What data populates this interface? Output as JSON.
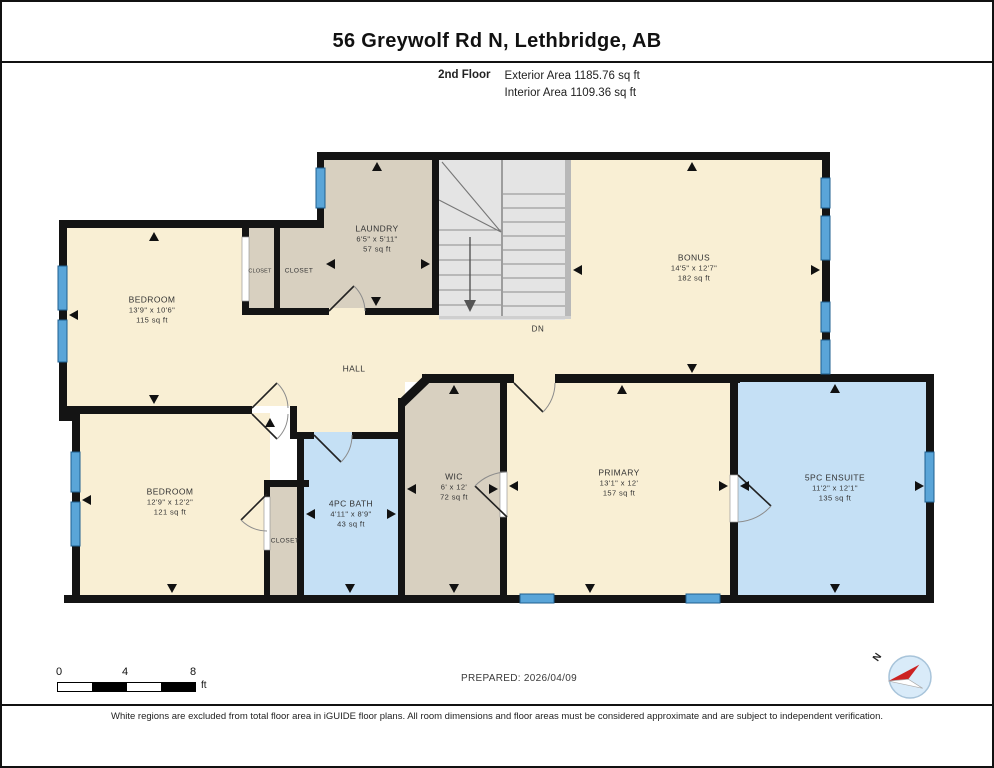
{
  "header": {
    "title": "56 Greywolf Rd N, Lethbridge, AB",
    "floor": "2nd Floor",
    "exterior": "Exterior Area 1185.76 sq ft",
    "interior": "Interior Area 1109.36 sq ft"
  },
  "rooms": {
    "bedroom1": {
      "name": "BEDROOM",
      "dims": "13'9\" x 10'6\"",
      "area": "115 sq ft"
    },
    "closet_a": {
      "name": "CLOSET"
    },
    "closet_b": {
      "name": "CLOSET"
    },
    "laundry": {
      "name": "LAUNDRY",
      "dims": "6'5\" x 5'11\"",
      "area": "57 sq ft"
    },
    "bonus": {
      "name": "BONUS",
      "dims": "14'5\" x 12'7\"",
      "area": "182 sq ft"
    },
    "hall": {
      "name": "HALL"
    },
    "stairs_dn": {
      "name": "DN"
    },
    "bedroom2": {
      "name": "BEDROOM",
      "dims": "12'9\" x 12'2\"",
      "area": "121 sq ft"
    },
    "closet_c": {
      "name": "CLOSET"
    },
    "bath": {
      "name": "4PC BATH",
      "dims": "4'11\" x 8'9\"",
      "area": "43 sq ft"
    },
    "wic": {
      "name": "WIC",
      "dims": "6' x 12'",
      "area": "72 sq ft"
    },
    "primary": {
      "name": "PRIMARY",
      "dims": "13'1\" x 12'",
      "area": "157 sq ft"
    },
    "ensuite": {
      "name": "5PC ENSUITE",
      "dims": "11'2\" x 12'1\"",
      "area": "135 sq ft"
    }
  },
  "footer": {
    "prepared": "PREPARED: 2026/04/09",
    "scale_ticks": [
      "0",
      "4",
      "8"
    ],
    "scale_unit": "ft",
    "compass": "N",
    "disclaimer": "White regions are excluded from total floor area in iGUIDE floor plans. All room dimensions and floor areas must be considered approximate and are subject to independent verification."
  },
  "colors": {
    "wall": "#141414",
    "room_cream": "#f9efd4",
    "room_tan": "#d8d0c0",
    "room_blue": "#c5e0f5",
    "stairs_gray": "#e4e4e4",
    "window_blue": "#5aa5d8"
  }
}
